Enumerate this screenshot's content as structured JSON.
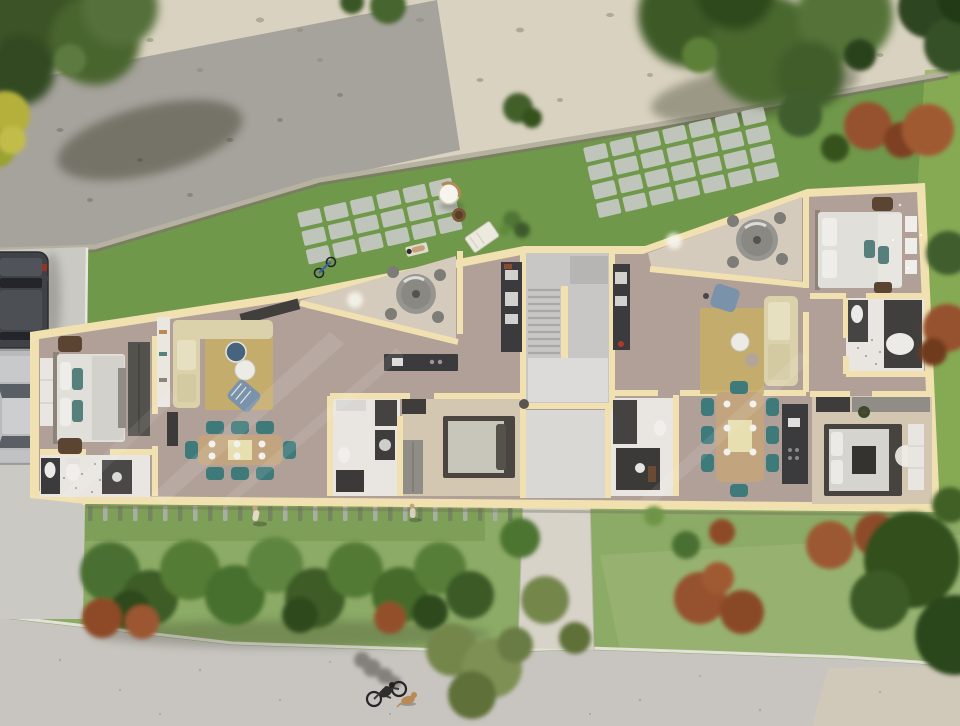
{
  "meta": {
    "title": "Aerial 3D floor plan render of an apartment building with garden",
    "view": "top-down dollhouse cutaway",
    "no_visible_text": true
  },
  "palette": {
    "gravel": "#d9d2c0",
    "path": "#a6a39c",
    "grass_top": "#70984a",
    "grass_bottom": "#8cab66",
    "grass_bright": "#8db058",
    "grass_light_patch": "#a0b879",
    "road": "#c8c5c0",
    "road_corner": "#d2c8b6",
    "driveway": "#cbc9c4",
    "walkway": "#d7d3c9",
    "curb": "#e4e1d9",
    "building_wall": "#f1e1b0",
    "floor_main": "#b0a098",
    "terrace_floor": "#d5cbbc",
    "bath_floor": "#e9e6e1",
    "carpet": "#d3c7b1",
    "entry_floor": "#dad8d4",
    "stair_floor": "#c8c7c5",
    "stair_upper": "#b6b5b3",
    "stair_landing": "#dcdbd9",
    "counter_dark": "#3b3b3d",
    "wardrobe_dark": "#54524d",
    "wardrobe_gray": "#908d87",
    "closet_white": "#e9e6e1",
    "bed_duvet": "#e1dfda",
    "pillow_teal": "#57807c",
    "sofa": "#dbd2ab",
    "rug": "#c5ad68",
    "chair_teal": "#3f7a7a",
    "table_wood": "#c2a57e",
    "armchair_blue": "#7b92ab",
    "armchair_brown": "#5c4433",
    "outdoor_table": "#97958f",
    "bush_dark": "#3c5a2a",
    "bush_mid": "#4f7634",
    "bush_olive": "#75864c",
    "bush_rust": "#97512d",
    "car_dark": "#3f4246",
    "car_silver": "#b9babc",
    "dog_tan": "#b98a56",
    "shadow": "#2f2e28",
    "light_glow": "#f6f4ec"
  },
  "site": {
    "areas": [
      "gravel bank",
      "gravel path with tree shadows",
      "upper lawn with paver patios",
      "front garden with shrub row",
      "street",
      "driveway with parked cars",
      "entrance walkway",
      "picket fence"
    ],
    "objects": [
      "parked SUV",
      "parked silver car",
      "hanging egg chair",
      "storage basket",
      "sun lounger",
      "sunbather on patio",
      "bicycle leaning at wall",
      "cyclist with dog on street",
      "two pedestrians on lawn"
    ]
  },
  "building": {
    "label": "single-storey apartment floor plan, two units around a central stairwell",
    "core": [
      "U-shaped staircase",
      "entry hall"
    ],
    "left_apartment": {
      "rooms": [
        "main bedroom",
        "en-suite bathroom",
        "living-dining room",
        "kitchen",
        "triangular terrace",
        "second bedroom",
        "second bathroom",
        "hallway"
      ]
    },
    "right_apartment": {
      "rooms": [
        "terrace",
        "living-dining room",
        "kitchen",
        "main bedroom",
        "en-suite bathroom",
        "second bedroom",
        "second bathroom",
        "hallway"
      ]
    }
  }
}
